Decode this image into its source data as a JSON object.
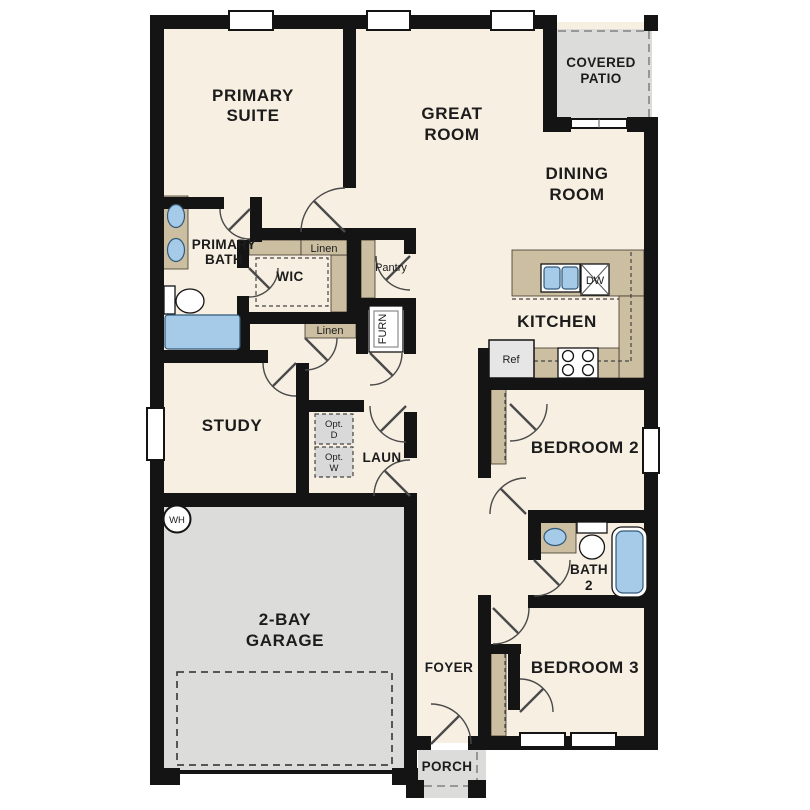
{
  "plan": {
    "type": "single-story residential floor plan",
    "rooms": {
      "primary_suite": {
        "lines": [
          "PRIMARY",
          "SUITE"
        ]
      },
      "great_room": {
        "lines": [
          "GREAT",
          "ROOM"
        ]
      },
      "covered_patio": {
        "lines": [
          "COVERED",
          "PATIO"
        ]
      },
      "dining_room": {
        "lines": [
          "DINING",
          "ROOM"
        ]
      },
      "primary_bath": {
        "lines": [
          "PRIMARY",
          "BATH"
        ]
      },
      "wic": {
        "label": "WIC"
      },
      "kitchen": {
        "label": "KITCHEN"
      },
      "study": {
        "label": "STUDY"
      },
      "laundry": {
        "label": "LAUN"
      },
      "garage": {
        "lines": [
          "2-BAY",
          "GARAGE"
        ]
      },
      "foyer": {
        "label": "FOYER"
      },
      "porch": {
        "label": "PORCH"
      },
      "bedroom_2": {
        "label": "BEDROOM 2"
      },
      "bath_2": {
        "lines": [
          "BATH",
          "2"
        ]
      },
      "bedroom_3": {
        "label": "BEDROOM 3"
      }
    },
    "storage": {
      "linen_wic": "Linen",
      "linen_hall": "Linen",
      "pantry": "Pantry",
      "furnace": "FURN"
    },
    "appliances": {
      "dishwasher": "DW",
      "refrigerator": "Ref",
      "water_heater": "WH",
      "optional_dryer": {
        "lines": [
          "Opt.",
          "D"
        ]
      },
      "optional_washer": {
        "lines": [
          "Opt.",
          "W"
        ]
      }
    },
    "colors": {
      "wall": "#141414",
      "floor": "#f7efe2",
      "outdoor_gray": "#dcdcda",
      "casework_tan": "#ccbea1",
      "fixture_blue": "#a6cbe9",
      "background": "#ffffff"
    }
  }
}
